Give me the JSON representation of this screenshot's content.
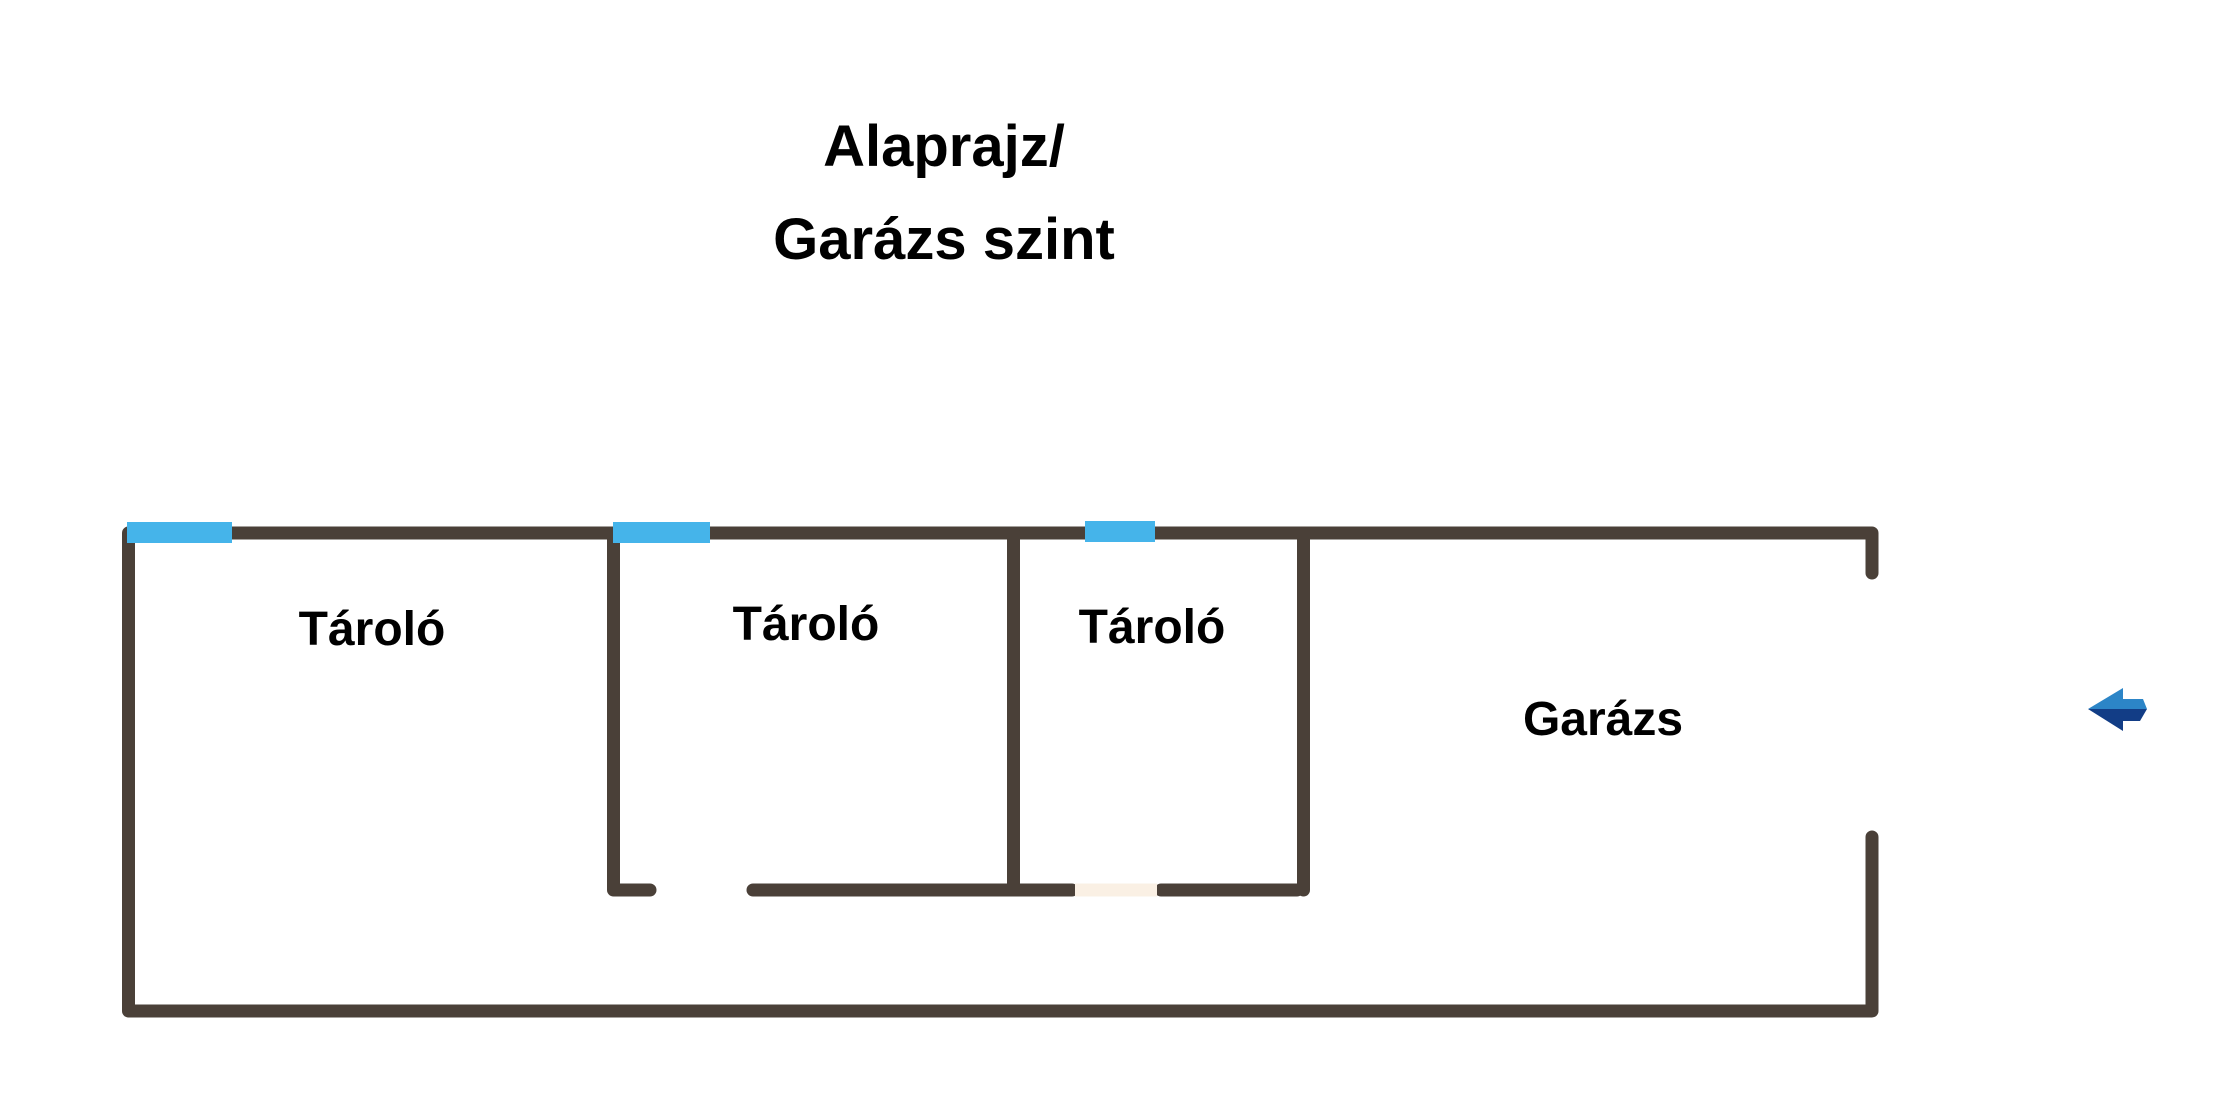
{
  "title": {
    "line1": "Alaprajz/",
    "line2": "Garázs szint"
  },
  "rooms": [
    {
      "id": "storage-1",
      "label": "Tároló"
    },
    {
      "id": "storage-2",
      "label": "Tároló"
    },
    {
      "id": "storage-3",
      "label": "Tároló"
    },
    {
      "id": "garage",
      "label": "Garázs"
    }
  ],
  "markers": {
    "windows": 3,
    "doors": 1,
    "entrance_arrow_direction": "left"
  },
  "colors": {
    "background": "#ffffff",
    "text": "#000000",
    "wall": "#4a4038",
    "window": "#45b4ea",
    "door": "#faf0e4",
    "arrow_light": "#2c85c7",
    "arrow_dark": "#123d86"
  }
}
